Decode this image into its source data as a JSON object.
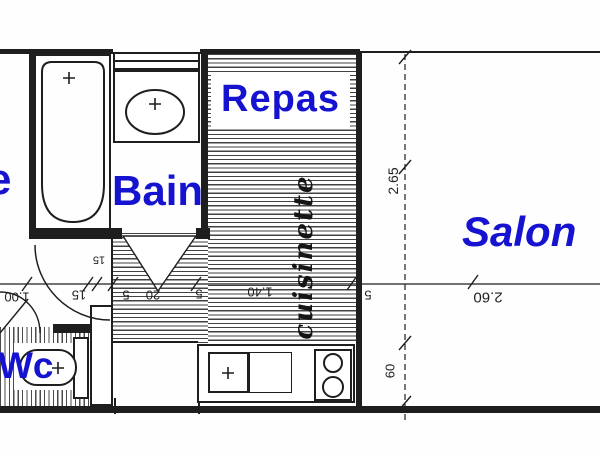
{
  "labels": {
    "entree_partial": "e",
    "bain": "Bain",
    "repas": "Repas",
    "salon": "Salon",
    "wc": "Wc",
    "cuisinette": "cuisinette"
  },
  "dims": {
    "entry_width": "1.00",
    "wall_thickness": "15",
    "wall_thickness_b": "15",
    "seg_5a": "5",
    "seg_20": "20",
    "seg_5b": "5",
    "kitchen_length": "1.40",
    "seg_5c": "5",
    "salon_width": "2.60",
    "salon_depth": "2.65",
    "counter_depth": "60"
  },
  "colors": {
    "label_blue": "#1512d0",
    "ink": "#1e1e1e",
    "paper": "#fefefe"
  }
}
